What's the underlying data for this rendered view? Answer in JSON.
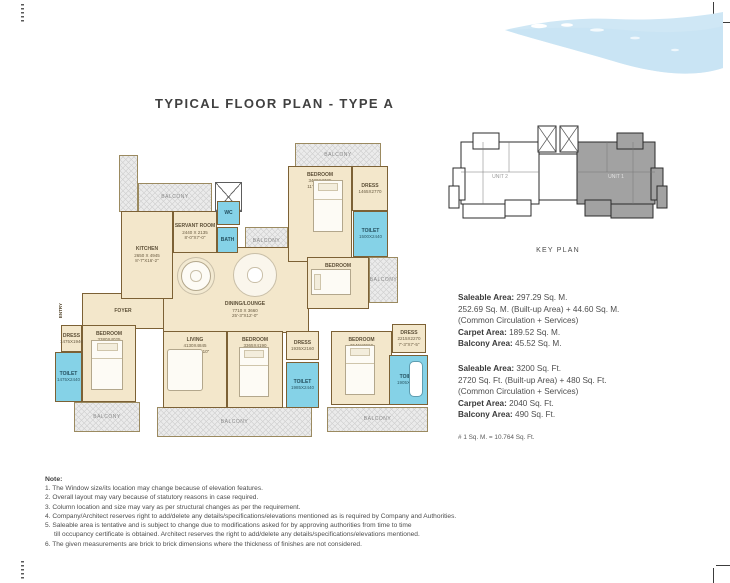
{
  "page": {
    "title": "TYPICAL FLOOR PLAN - TYPE A"
  },
  "colors": {
    "wall": "#7c6135",
    "floor": "#f3e7cb",
    "toilet_blue": "#85d2e7",
    "balcony_gray": "#ebebeb",
    "wave_blue": "#cfe7f5",
    "keyplan_shade": "#a2a2a2",
    "text": "#4d4d4d"
  },
  "key_plan": {
    "label": "KEY PLAN",
    "unit1_label": "UNIT 1",
    "unit2_label": "UNIT 2"
  },
  "areas_metric": {
    "lines": [
      {
        "b": "Saleable Area:",
        "t": " 297.29 Sq. M."
      },
      {
        "t": "252.69 Sq. M. (Built-up Area) + 44.60 Sq. M."
      },
      {
        "t": "(Common Circulation + Services)"
      },
      {
        "b": "Carpet Area:",
        "t": " 189.52 Sq. M."
      },
      {
        "b": "Balcony Area:",
        "t": " 45.52 Sq. M."
      }
    ]
  },
  "areas_imperial": {
    "lines": [
      {
        "b": "Saleable Area:",
        "t": " 3200 Sq. Ft."
      },
      {
        "t": "2720 Sq. Ft. (Built-up Area) + 480 Sq. Ft."
      },
      {
        "t": "(Common Circulation + Services)"
      },
      {
        "b": "Carpet Area:",
        "t": " 2040 Sq. Ft."
      },
      {
        "b": "Balcony Area:",
        "t": " 490 Sq. Ft."
      }
    ]
  },
  "conversion_note": "# 1 Sq. M. = 10.764 Sq. Ft.",
  "notes": {
    "heading": "Note:",
    "items": [
      "The Window size/its location may change because of elevation features.",
      "Overall layout may vary because of statutory reasons in case required.",
      "Column location and size may vary as per structural changes as per the requirement.",
      "Company/Architect reserves right to add/delete any details/specifications/elevations mentioned as is required by Company and Authorities.",
      "Saleable area is tentative and is subject to change due to modifications asked for by approving authorities from time to time\ntill occupancy certificate is obtained. Architect reserves the right to add/delete any details/specifications/elevations mentioned.",
      "The given measurements are brick to brick dimensions where the thickness of finishes are not considered."
    ]
  },
  "floorplan": {
    "elements": [
      {
        "n": "balcony-top-left-wing",
        "t": "balcony",
        "x": 64,
        "y": 20,
        "w": 19,
        "h": 57
      },
      {
        "n": "balcony-top-left",
        "t": "balcony",
        "label": "BALCONY",
        "x": 83,
        "y": 48,
        "w": 74,
        "h": 29
      },
      {
        "n": "balcony-mid-top",
        "t": "balcony",
        "label": "BALCONY",
        "x": 190,
        "y": 92,
        "w": 43,
        "h": 28
      },
      {
        "n": "balcony-top-right",
        "t": "balcony",
        "label": "BALCONY",
        "x": 240,
        "y": 8,
        "w": 86,
        "h": 24
      },
      {
        "n": "balcony-right",
        "t": "balcony",
        "label": "BALCONY",
        "x": 314,
        "y": 122,
        "w": 29,
        "h": 46
      },
      {
        "n": "balcony-bottom-left",
        "t": "balcony",
        "label": "BALCONY",
        "x": 19,
        "y": 267,
        "w": 66,
        "h": 30
      },
      {
        "n": "balcony-bottom-middle",
        "t": "balcony",
        "label": "BALCONY",
        "x": 102,
        "y": 272,
        "w": 155,
        "h": 30
      },
      {
        "n": "balcony-bottom-right",
        "t": "balcony",
        "label": "BALCONY",
        "x": 272,
        "y": 272,
        "w": 101,
        "h": 25
      },
      {
        "n": "hall",
        "t": "room",
        "x": 108,
        "y": 112,
        "w": 146,
        "h": 86
      },
      {
        "n": "foyer",
        "t": "room",
        "label": "FOYER",
        "x": 27,
        "y": 158,
        "w": 82,
        "h": 36
      },
      {
        "n": "kitchen",
        "t": "room",
        "label": "KITCHEN",
        "d1": "2650 X 4945",
        "d2": "8'-7\"X16'-2\"",
        "x": 66,
        "y": 76,
        "w": 52,
        "h": 88
      },
      {
        "n": "servant-room",
        "t": "room",
        "label": "SERVANT ROOM",
        "d1": "2440 X 2135",
        "d2": "8'-0\"X7'-0\"",
        "x": 118,
        "y": 76,
        "w": 44,
        "h": 42
      },
      {
        "n": "lift-shaft",
        "t": "shaft",
        "x": 160,
        "y": 47,
        "w": 27,
        "h": 30
      },
      {
        "n": "servant-wc",
        "t": "toilet",
        "label": "WC",
        "x": 162,
        "y": 66,
        "w": 23,
        "h": 24
      },
      {
        "n": "servant-bath",
        "t": "toilet",
        "label": "BATH",
        "x": 162,
        "y": 92,
        "w": 21,
        "h": 26
      },
      {
        "n": "bedroom-2",
        "t": "room",
        "cls": "label-top",
        "label": "BEDROOM",
        "d1": "3480X3725",
        "d2": "11'-5\"X12'-2\"",
        "x": 233,
        "y": 31,
        "w": 64,
        "h": 96
      },
      {
        "n": "dress-2",
        "t": "room",
        "label": "DRESS",
        "d1": "1465X2770",
        "x": 297,
        "y": 31,
        "w": 36,
        "h": 45
      },
      {
        "n": "toilet-2",
        "t": "toilet",
        "label": "TOILET",
        "d1": "1500X2440",
        "x": 298,
        "y": 76,
        "w": 35,
        "h": 46
      },
      {
        "n": "bedroom-5",
        "t": "room",
        "cls": "label-top",
        "label": "BEDROOM",
        "d1": "3060X2795",
        "x": 252,
        "y": 122,
        "w": 62,
        "h": 52
      },
      {
        "n": "living-room",
        "t": "room",
        "cls": "label-top",
        "label": "LIVING",
        "d1": "4130X4845",
        "d2": "13'-6\"X15'-10\"",
        "x": 108,
        "y": 196,
        "w": 64,
        "h": 77
      },
      {
        "n": "bedroom-3",
        "t": "room",
        "cls": "label-top",
        "label": "BEDROOM",
        "d1": "3380X4025",
        "d2": "11'-1\"X13'-2\"",
        "x": 27,
        "y": 190,
        "w": 54,
        "h": 77
      },
      {
        "n": "dress-3",
        "t": "room",
        "label": "DRESS",
        "d1": "1475X1940",
        "x": 6,
        "y": 190,
        "w": 21,
        "h": 27
      },
      {
        "n": "toilet-3",
        "t": "toilet",
        "label": "TOILET",
        "d1": "1475X2440",
        "x": 0,
        "y": 217,
        "w": 27,
        "h": 50
      },
      {
        "n": "bedroom-4",
        "t": "room",
        "cls": "label-top",
        "label": "BEDROOM",
        "d1": "3365X4190",
        "d2": "11'-0\"X13'-9\"",
        "x": 172,
        "y": 196,
        "w": 56,
        "h": 77
      },
      {
        "n": "dress-4",
        "t": "room",
        "label": "DRESS",
        "d1": "1935X2160",
        "x": 231,
        "y": 196,
        "w": 33,
        "h": 29
      },
      {
        "n": "toilet-4",
        "t": "toilet",
        "label": "TOILET",
        "d1": "1985X2440",
        "x": 231,
        "y": 227,
        "w": 33,
        "h": 46
      },
      {
        "n": "bedroom-1",
        "t": "room",
        "cls": "label-top",
        "label": "BEDROOM",
        "d1": "3545X3960",
        "d2": "11'-7\"X13'-0\"",
        "x": 276,
        "y": 196,
        "w": 61,
        "h": 74
      },
      {
        "n": "dress-1",
        "t": "room",
        "label": "DRESS",
        "d1": "2215X2270",
        "d2": "7'-3\"X7'-5\"",
        "x": 337,
        "y": 189,
        "w": 34,
        "h": 29
      },
      {
        "n": "toilet-1",
        "t": "toilet",
        "label": "TOILET",
        "d1": "1905X2745",
        "x": 334,
        "y": 220,
        "w": 39,
        "h": 50
      },
      {
        "n": "entry-label",
        "t": "vlabel",
        "label": "ENTRY",
        "x": 0,
        "y": 158,
        "w": 10,
        "h": 36
      },
      {
        "n": "dining-table",
        "t": "tableR",
        "x": 126,
        "y": 126,
        "w": 30,
        "h": 30
      },
      {
        "n": "lounge-seating",
        "t": "loungeR",
        "x": 178,
        "y": 118,
        "w": 44,
        "h": 44
      },
      {
        "n": "bed",
        "t": "bed",
        "x": 258,
        "y": 45,
        "w": 30,
        "h": 52
      },
      {
        "n": "bed",
        "t": "bed-h",
        "x": 256,
        "y": 134,
        "w": 40,
        "h": 26
      },
      {
        "n": "bed",
        "t": "bed",
        "x": 36,
        "y": 205,
        "w": 32,
        "h": 50
      },
      {
        "n": "bed",
        "t": "bed",
        "x": 184,
        "y": 212,
        "w": 30,
        "h": 50
      },
      {
        "n": "bed",
        "t": "bed",
        "x": 290,
        "y": 210,
        "w": 30,
        "h": 50
      },
      {
        "n": "sofa",
        "t": "sofa",
        "x": 112,
        "y": 214,
        "w": 36,
        "h": 42
      },
      {
        "n": "bathtub",
        "t": "tub",
        "x": 354,
        "y": 226,
        "w": 14,
        "h": 36
      },
      {
        "n": "dining-lounge-label",
        "t": "flabel",
        "label": "DINING/LOUNGE",
        "d1": "7710 X 3660",
        "d2": "25'-3\"X12'-0\"",
        "x": 158,
        "y": 162,
        "w": 64,
        "h": 26
      }
    ]
  }
}
